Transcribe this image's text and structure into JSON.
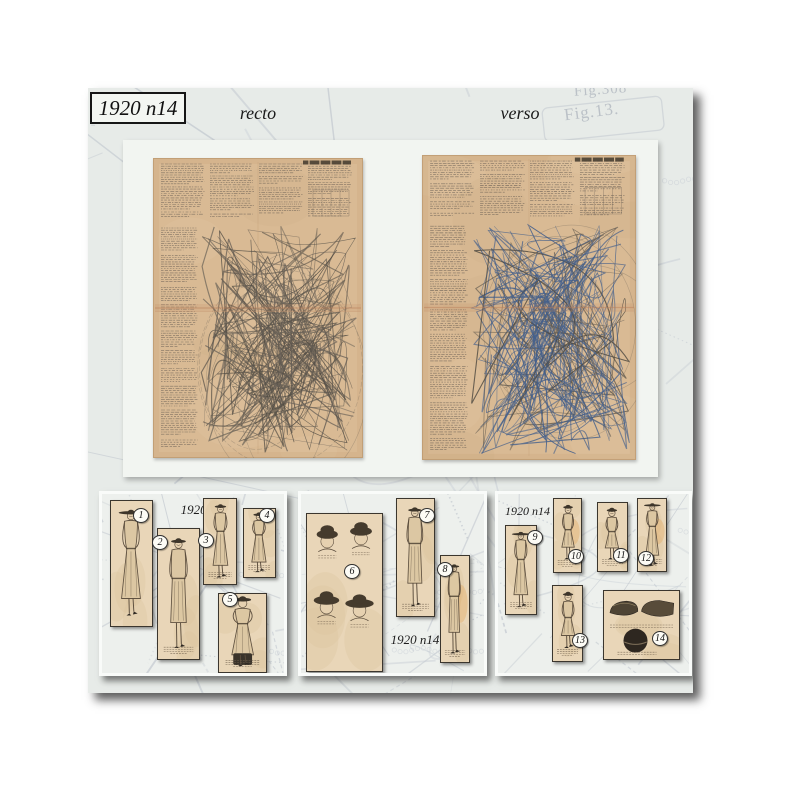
{
  "header": {
    "pattern_id": "1920 n14",
    "recto_label": "recto",
    "verso_label": "verso"
  },
  "watermark": {
    "labels": [
      {
        "text": "Fig.308"
      },
      {
        "text": "Fig.13."
      }
    ]
  },
  "sheets": [
    {
      "side": "recto"
    },
    {
      "side": "verso"
    }
  ],
  "panels": [
    {
      "caption": "1920 n14",
      "figures": [
        {
          "number": "1"
        },
        {
          "number": "2"
        },
        {
          "number": "3"
        },
        {
          "number": "4"
        },
        {
          "number": "5"
        }
      ]
    },
    {
      "caption": "1920 n14",
      "figures": [
        {
          "number": "6"
        },
        {
          "number": "7"
        },
        {
          "number": "8"
        }
      ]
    },
    {
      "caption": "1920 n14",
      "figures": [
        {
          "number": "9"
        },
        {
          "number": "10"
        },
        {
          "number": "11"
        },
        {
          "number": "12"
        },
        {
          "number": "13"
        },
        {
          "number": "14"
        }
      ]
    }
  ],
  "colors": {
    "photo_background": "#e7ebe8",
    "card_background": "#f2f5f1",
    "sheet_paper": "#d9ba94",
    "thumb_paper": "#e9d6b8",
    "pattern_ink": "#57524b",
    "pattern_ink_blue": "#44608c",
    "crease": "#c08a66",
    "watermark_line": "#c4cad1"
  }
}
